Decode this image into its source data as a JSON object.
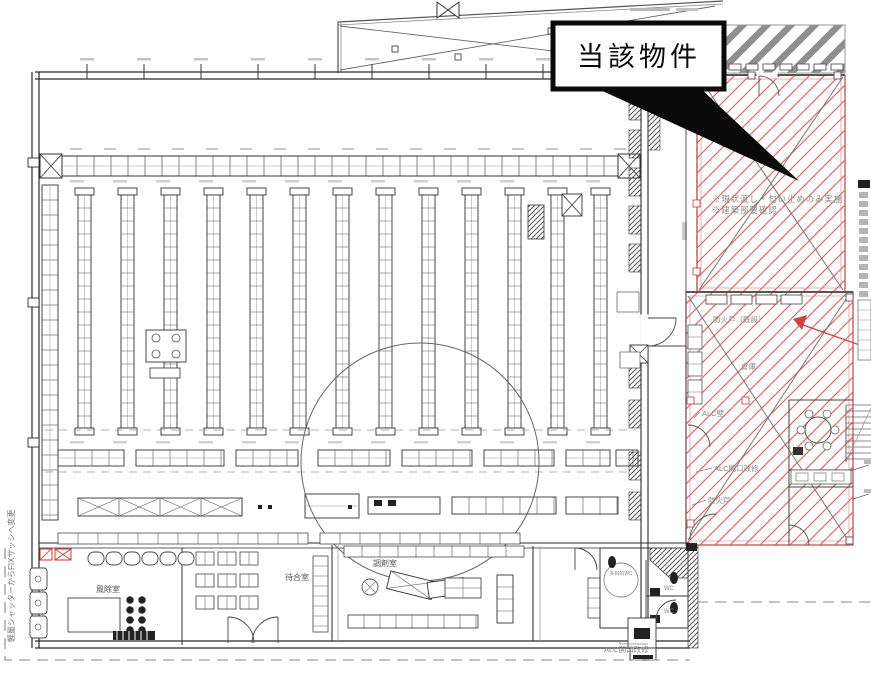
{
  "callout": {
    "label": "当該物件"
  },
  "red_area": {
    "note_line1": "※現状渡し・匂い止めのみ実施",
    "note_line2": "※建築部要確認",
    "fire_door_existing": "防火戸（既設）",
    "storage_label": "倉庫",
    "alc_wall_label": "ALC壁",
    "alc_opening_label": "ALC開口改修",
    "fire_door_label": "防火戸"
  },
  "store": {
    "wind_lobby_label": "風除室",
    "waiting_room_label": "待合室",
    "dispensing_room_label": "調剤室",
    "wc_label_1": "WC",
    "wc_label_2": "WC",
    "accessible_wc_label": "多目的WC",
    "alc_opening_note": "ALC開口改修",
    "shutter_note": "軽量シャッターからFIXサッシへ変更"
  },
  "colors": {
    "red_hatch": "#d96a6a",
    "red_border": "#c05050",
    "annotation_red": "#cc4444",
    "line": "#2b2b2b",
    "gray_note": "#8a8a8a",
    "roof_stripe": "#8f8f8f"
  }
}
